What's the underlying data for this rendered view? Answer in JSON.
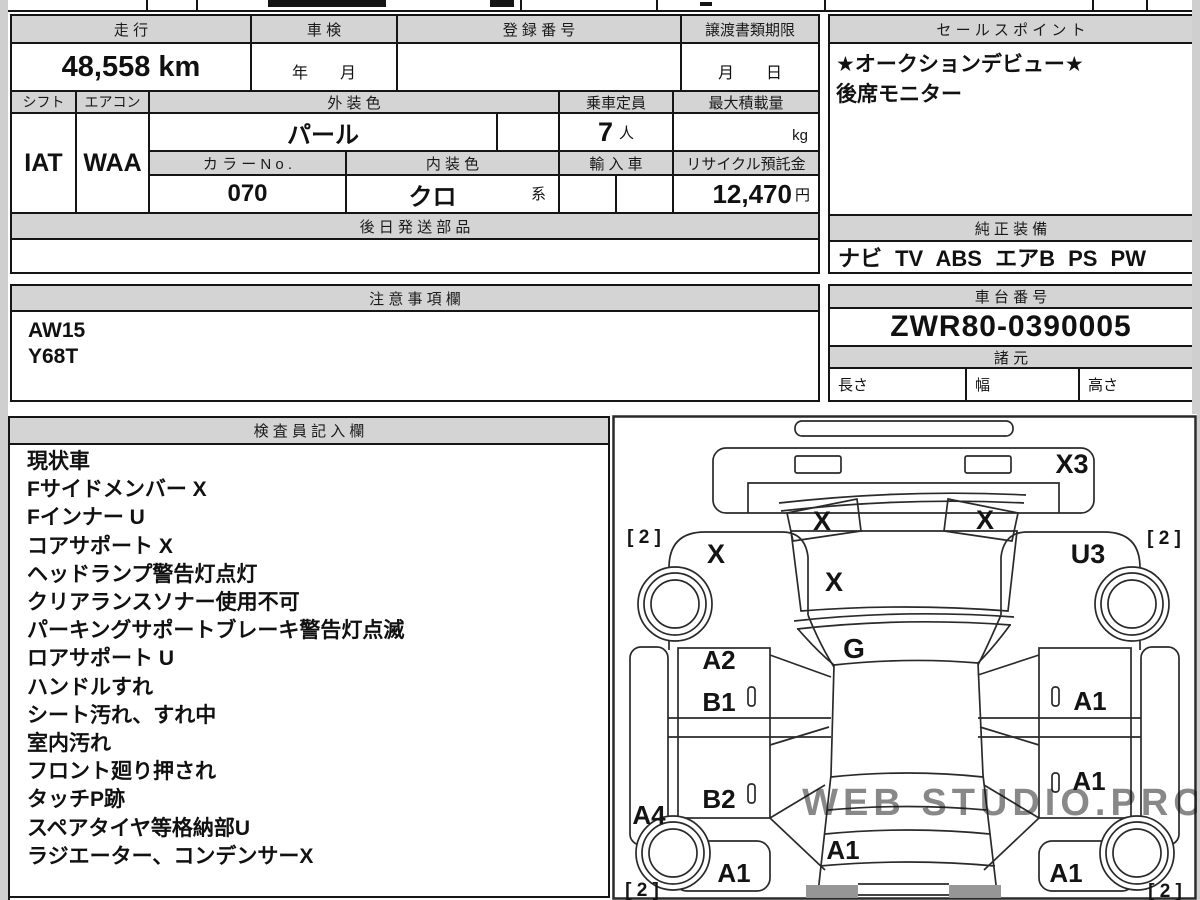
{
  "top_table": {
    "mileage": {
      "label": "走 行",
      "value": "48,558 km"
    },
    "inspection": {
      "label": "車 検",
      "value": "年　　月"
    },
    "registration": {
      "label": "登 録 番 号",
      "value": ""
    },
    "transfer_deadline": {
      "label": "譲渡書類期限",
      "value": "月　　日"
    },
    "shift": {
      "label": "シフト",
      "value": "IAT"
    },
    "aircon": {
      "label": "エアコン",
      "value": "WAA"
    },
    "exterior_color": {
      "label": "外 装 色",
      "value": "パール"
    },
    "capacity": {
      "label": "乗車定員",
      "value": "7",
      "unit": "人"
    },
    "max_load": {
      "label": "最大積載量",
      "unit": "kg"
    },
    "color_no": {
      "label": "カ ラ ー N o .",
      "value": "070"
    },
    "interior_color": {
      "label": "内 装 色",
      "value": "クロ",
      "suffix": "系"
    },
    "import_car": {
      "label": "輸 入 車"
    },
    "recycle_deposit": {
      "label": "リサイクル預託金",
      "value": "12,470",
      "unit": "円"
    },
    "later_parts": {
      "label": "後 日 発 送 部 品",
      "value": ""
    }
  },
  "sales_point": {
    "title": "セ ー ル ス ポ イ ン ト",
    "lines": [
      "★オークションデビュー★",
      "後席モニター"
    ]
  },
  "genuine_equipment": {
    "title": "純 正 装 備",
    "value": "ナビ TV ABS エアB PS PW"
  },
  "notes": {
    "title": "注 意 事 項 欄",
    "lines": [
      "AW15",
      "Y68T"
    ]
  },
  "chassis": {
    "title": "車 台 番 号",
    "value": "ZWR80-0390005"
  },
  "specs": {
    "title": "諸 元",
    "length_label": "長さ",
    "width_label": "幅",
    "height_label": "高さ",
    "length": "",
    "width": "",
    "height": ""
  },
  "inspector": {
    "title": "検 査 員 記 入 欄",
    "lines": [
      "現状車",
      "Fサイドメンバー X",
      "Fインナー U",
      "コアサポート X",
      "ヘッドランプ警告灯点灯",
      "クリアランスソナー使用不可",
      "パーキングサポートブレーキ警告灯点滅",
      "ロアサポート U",
      "ハンドルすれ",
      "シート汚れ、すれ中",
      "室内汚れ",
      "フロント廻り押され",
      "タッチP跡",
      "スペアタイヤ等格納部U",
      "ラジエーター、コンデンサーX"
    ]
  },
  "diagram": {
    "labels": {
      "front_bumper": "X3",
      "headlight_left": "X",
      "headlight_right": "X",
      "fender_left": "X",
      "fender_right": "U3",
      "hood": "X",
      "windshield": "G",
      "door_front_left_upper": "A2",
      "door_front_left": "B1",
      "door_slide_left": "B2",
      "door_front_right": "A1",
      "door_slide_right": "A1",
      "rocker_left": "A4",
      "quarter_left": "A1",
      "quarter_right": "A1",
      "tailgate": "A1",
      "tread_front_left": "[ 2 ]",
      "tread_front_right": "[ 2 ]",
      "tread_rear_left": "[ 2 ]",
      "tread_rear_right": "[ 2 ]"
    },
    "watermark": "WEB STUDIO.PRO",
    "colors": {
      "line": "#2a2a2a",
      "taillight_gray": "#969696",
      "header_gray": "#d4d4d4"
    }
  }
}
